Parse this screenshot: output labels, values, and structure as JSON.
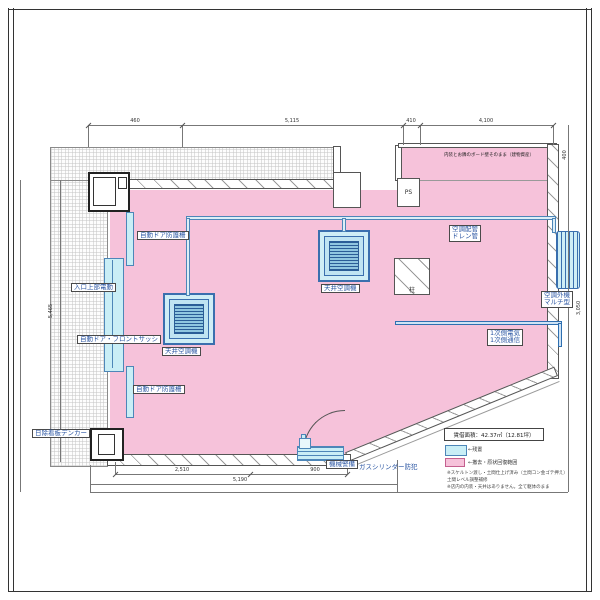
{
  "title": "floor-plan-drawing",
  "note_top_right": "内装とお隣のボード壁そのまま（建物資産）",
  "labels": {
    "guard_upper": "自動ドア防護柵",
    "entrance_motor": "入口上部電動",
    "front_sash": "自動ドア・フロントサッシ",
    "guard_lower": "自動ドア防護柵",
    "awning": "日除看板デンカー",
    "ceiling_ac": "天井空調機",
    "piping_1": "空調配管",
    "piping_2": "ドレン管",
    "outdoor_1": "空調外機",
    "outdoor_2": "マルチ型",
    "primary_1": "1次側電気",
    "primary_2": "1次側通信",
    "machine": "機械警備",
    "gas": "ガスシリンダー防犯",
    "pillar": "柱",
    "ps": "PS"
  },
  "dims": {
    "top1": "460",
    "top2": "5,115",
    "top3": "410",
    "top4": "4,100",
    "left": "5,465",
    "right": "400",
    "right2": "3,050",
    "b1": "2,510",
    "b2": "900",
    "b3": "5,190"
  },
  "legend": {
    "title": "賃借面積：42.37㎡（12.81坪）",
    "item1": "←残置",
    "item2": "←撤去・原状回復範囲",
    "note1": "※スケルトン渡し・土間仕上げ済み（土間コン金ゴテ押え）",
    "note2": "土間レベル調整補修",
    "note3": "※店内の内装・天井はありません。全て躯体のまま"
  },
  "colors": {
    "pink": "#f6c2da",
    "cyan": "#c9eef6",
    "pipe_blue": "#4d86b8",
    "label_blue": "#2b56a3"
  }
}
